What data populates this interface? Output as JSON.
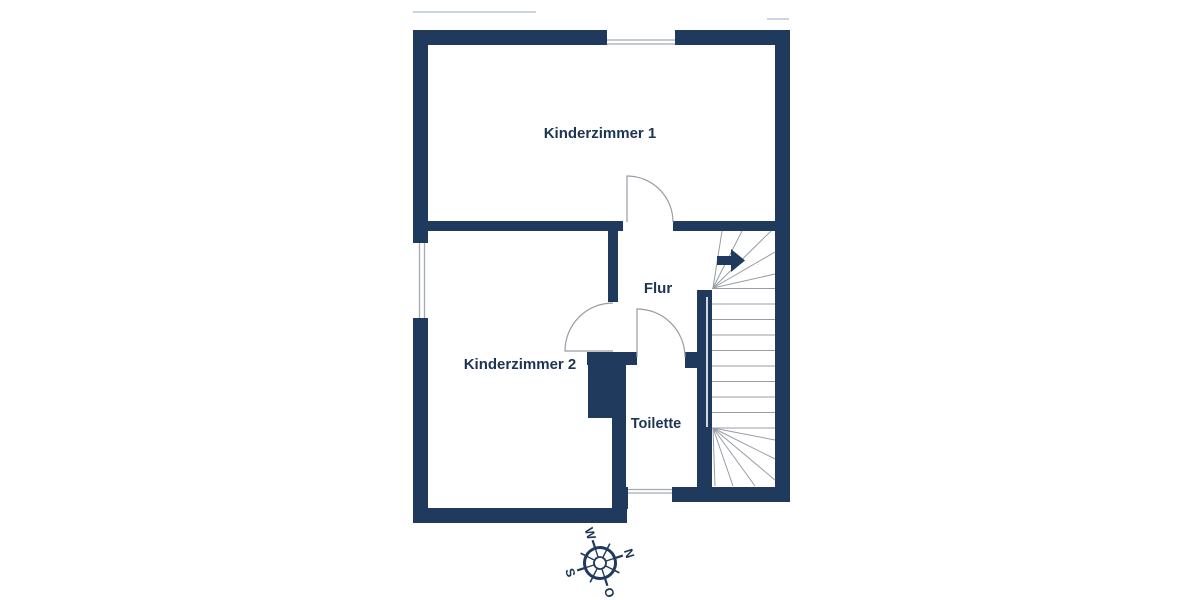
{
  "plan": {
    "rooms": {
      "kinderzimmer1": {
        "label": "Kinderzimmer 1"
      },
      "kinderzimmer2": {
        "label": "Kinderzimmer 2"
      },
      "flur": {
        "label": "Flur"
      },
      "toilette": {
        "label": "Toilette"
      }
    },
    "compass": {
      "north": "N",
      "east": "O",
      "south": "S",
      "west": "W"
    },
    "colors": {
      "wall": "#1f3a5c",
      "label_text": "#1d3552",
      "line_gray": "#979da4",
      "window_line": "#a3aab1",
      "faint_line": "#ccd4dc",
      "background": "#ffffff"
    }
  }
}
